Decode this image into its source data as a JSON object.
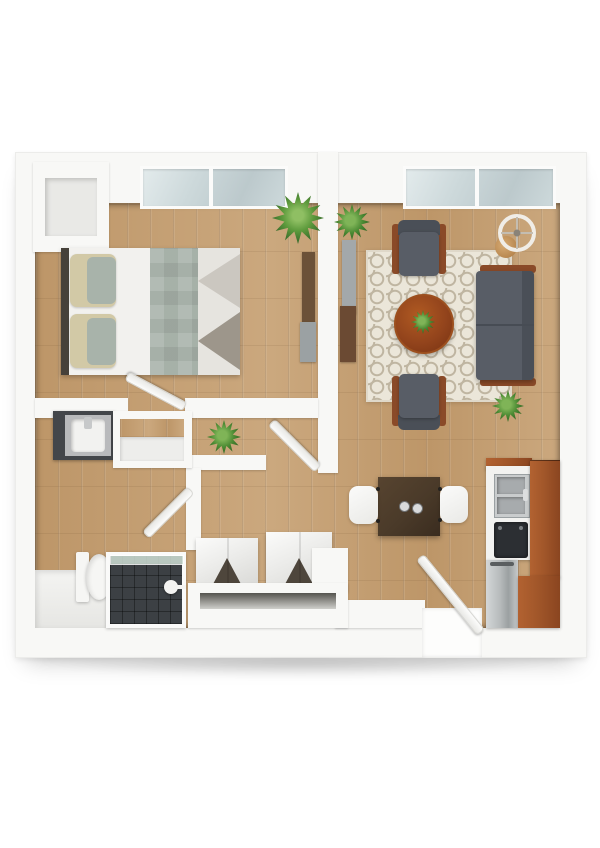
{
  "scene": {
    "type": "3d-floor-plan-top-view",
    "description": "Top-down 3D rendering of a one-bedroom apartment floor plan on a white background",
    "rooms": [
      {
        "name": "bedroom",
        "furniture": [
          "double-bed",
          "pillows x2",
          "sage-runner-blanket",
          "chevron-foot-throw",
          "media-console",
          "fern-plant",
          "window",
          "door"
        ]
      },
      {
        "name": "living-room",
        "furniture": [
          "sofa",
          "armchair x2",
          "round-coffee-table",
          "table-plant",
          "area-rug",
          "floor-lamp",
          "side-table",
          "media-console",
          "potted-plant x2",
          "window"
        ]
      },
      {
        "name": "dining-area",
        "furniture": [
          "dining-table",
          "dining-chair x2",
          "cup x2"
        ]
      },
      {
        "name": "kitchen",
        "furniture": [
          "double-bowl-sink",
          "cooktop",
          "refrigerator",
          "tall-cabinet",
          "base-cabinet",
          "counter"
        ]
      },
      {
        "name": "bathroom",
        "furniture": [
          "vanity-sink",
          "toilet",
          "walk-in-shower",
          "glass-screen",
          "door"
        ]
      },
      {
        "name": "hallway",
        "furniture": [
          "potted-plant",
          "closet-niche",
          "utility-shaft",
          "door x2"
        ]
      },
      {
        "name": "storage-nook",
        "furniture": [
          "a-frame-shelf x2",
          "storage-counter",
          "corner-cabinet"
        ]
      },
      {
        "name": "entry",
        "furniture": [
          "entry-door",
          "threshold"
        ]
      }
    ],
    "counts": {
      "windows": 2,
      "doors": 4,
      "plants": 5,
      "armchairs": 2,
      "dining-chairs": 2
    },
    "palette": {
      "wall": "#f8f8f6",
      "floor-wood": "#bd9668",
      "floor-wood-light": "#cba87e",
      "window-glass": "#cdd9db",
      "rug-base": "#ebe6d9",
      "rug-pattern": "#bfb5a1",
      "shower-tile": "#3c4044",
      "glass": "#cfe0d6",
      "sofa": "#585d66",
      "sofa-dark": "#4a4f57",
      "chair-wood": "#8a4a28",
      "coffee-table": "#93441c",
      "dining-table": "#4a3a29",
      "kitchen-cherry": "#a2572a",
      "steel": "#b6babb",
      "stove": "#2c2f33",
      "bed-cream": "#d2c9a6",
      "bed-sage": "#a8b3aa",
      "headboard": "#46413a",
      "linen": "#f2f1ee",
      "plant-dark": "#2c5e20",
      "plant-mid": "#4b8a33",
      "plant-light": "#7fb457"
    }
  }
}
